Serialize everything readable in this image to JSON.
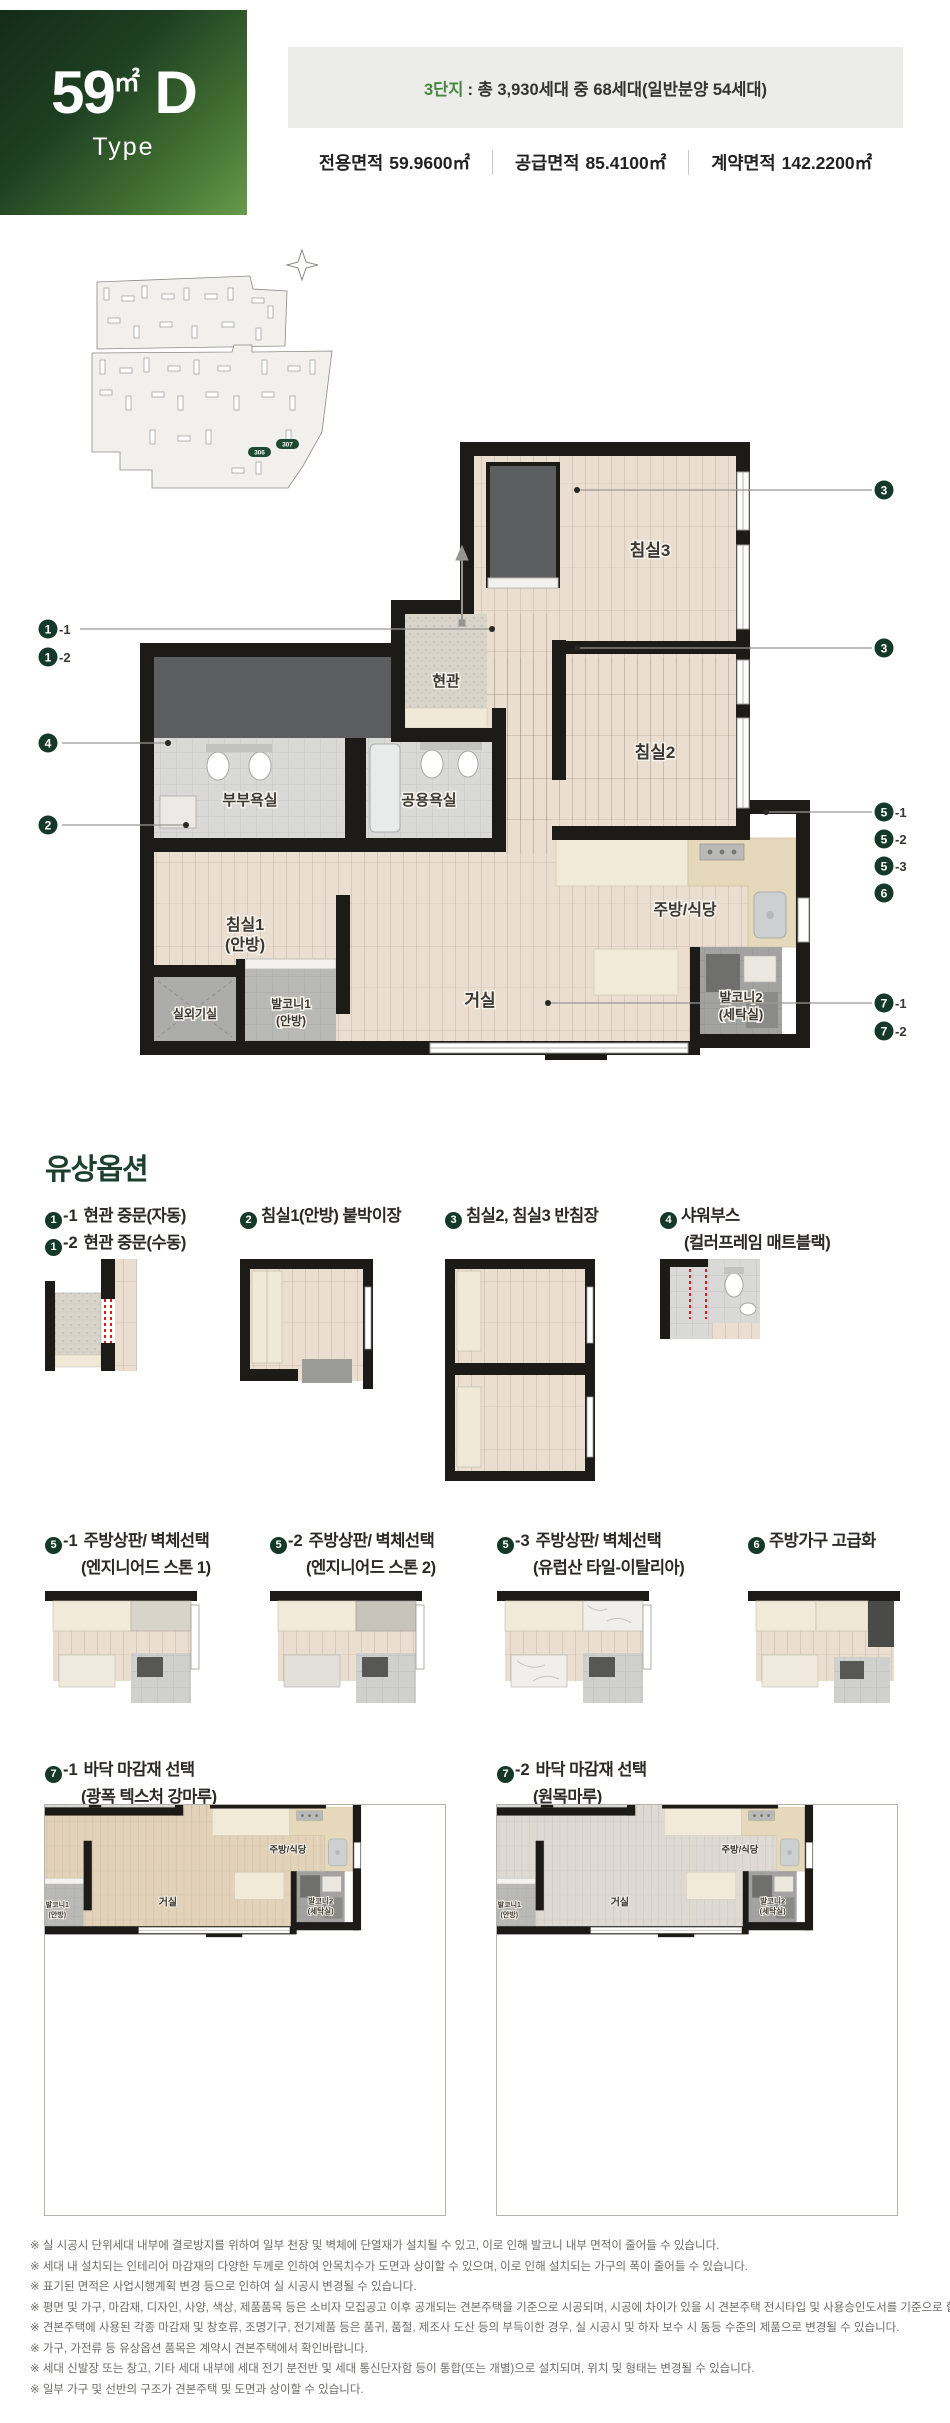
{
  "header": {
    "type_big": "59",
    "type_unit": "㎡",
    "type_letter": "D",
    "type_sub": "Type",
    "complex_prefix": "3단지",
    "complex_rest": ": 총 3,930세대 중 68세대(일반분양 54세대)",
    "areas": [
      {
        "label": "전용면적",
        "value": "59.9600㎡"
      },
      {
        "label": "공급면적",
        "value": "85.4100㎡"
      },
      {
        "label": "계약면적",
        "value": "142.2200㎡"
      }
    ]
  },
  "site_plan": {
    "badges": [
      "306",
      "307"
    ]
  },
  "floor_plan": {
    "rooms": {
      "entrance": "현관",
      "bed3": "침실3",
      "bed2": "침실2",
      "bath_master": "부부욕실",
      "bath_common": "공용욕실",
      "kitchen": "주방/식당",
      "bed1_line1": "침실1",
      "bed1_line2": "(안방)",
      "living": "거실",
      "balcony2_line1": "발코니2",
      "balcony2_line2": "(세탁실)",
      "outdoor_unit": "실외기실",
      "balcony1_line1": "발코니1",
      "balcony1_line2": "(안방)"
    },
    "callouts_left": [
      {
        "num": "1",
        "suffix": "-1"
      },
      {
        "num": "1",
        "suffix": "-2"
      },
      {
        "num": "4",
        "suffix": ""
      },
      {
        "num": "2",
        "suffix": ""
      }
    ],
    "callouts_right": [
      {
        "num": "3",
        "suffix": ""
      },
      {
        "num": "3",
        "suffix": ""
      },
      {
        "num": "5",
        "suffix": "-1"
      },
      {
        "num": "5",
        "suffix": "-2"
      },
      {
        "num": "5",
        "suffix": "-3"
      },
      {
        "num": "6",
        "suffix": ""
      },
      {
        "num": "7",
        "suffix": "-1"
      },
      {
        "num": "7",
        "suffix": "-2"
      }
    ]
  },
  "options": {
    "title": "유상옵션",
    "row1": [
      {
        "circle": "1",
        "suffix": "-1",
        "label": "현관 중문(자동)",
        "circle2": "1",
        "suffix2": "-2",
        "label2": "현관 중문(수동)"
      },
      {
        "circle": "2",
        "suffix": "",
        "label": "침실1(안방) 붙박이장"
      },
      {
        "circle": "3",
        "suffix": "",
        "label": "침실2, 침실3 반침장"
      },
      {
        "circle": "4",
        "suffix": "",
        "label": "샤워부스",
        "sub": "(컬러프레임 매트블랙)"
      }
    ],
    "row2": [
      {
        "circle": "5",
        "suffix": "-1",
        "label": "주방상판/ 벽체선택",
        "sub": "(엔지니어드 스톤 1)"
      },
      {
        "circle": "5",
        "suffix": "-2",
        "label": "주방상판/ 벽체선택",
        "sub": "(엔지니어드 스톤 2)"
      },
      {
        "circle": "5",
        "suffix": "-3",
        "label": "주방상판/ 벽체선택",
        "sub": "(유럽산 타일-이탈리아)"
      },
      {
        "circle": "6",
        "suffix": "",
        "label": "주방가구 고급화"
      }
    ],
    "row3": [
      {
        "circle": "7",
        "suffix": "-1",
        "label": "바닥 마감재 선택",
        "sub": "(광폭 텍스처 강마루)"
      },
      {
        "circle": "7",
        "suffix": "-2",
        "label": "바닥 마감재 선택",
        "sub": "(원목마루)"
      }
    ]
  },
  "notes": [
    "※ 실 시공시 단위세대 내부에 결로방지를 위하여 일부 천장 및 벽체에 단열재가 설치될 수 있고, 이로 인해 발코니 내부 면적이 줄어들 수 있습니다.",
    "※ 세대 내 설치되는 인테리어 마감재의 다양한 두께로 인하여 안목치수가 도면과 상이할 수 있으며, 이로 인해 설치되는 가구의 폭이 줄어들 수 있습니다.",
    "※ 표기된 면적은 사업시행계획 변경 등으로 인하여 실 시공시 변경될 수 있습니다.",
    "※ 평면 및 가구, 마감재, 디자인, 사양, 색상, 제품품목 등은 소비자 모집공고 이후 공개되는 견본주택을 기준으로 시공되며, 시공에 차이가 있을 시 견본주택 전시타입 및 사용승인도서를 기준으로 합니다.",
    "※ 견본주택에 사용된 각종 마감재 및 창호류, 조명기구, 전기제품 등은 품귀, 품절, 제조사 도산 등의 부득이한 경우, 실 시공시 및 하자 보수 시 동등 수준의 제품으로 변경될 수 있습니다.",
    "※ 가구, 가전류 등 유상옵션 품목은 계약시 견본주택에서 확인바랍니다.",
    "※ 세대 신발장 또는 창고, 기타 세대 내부에 세대 전기 분전반 및 세대 통신단자함 등이 통합(또는 개별)으로 설치되며, 위치 및 형태는 변경될 수 있습니다.",
    "※ 일부 가구 및 선반의 구조가 견본주택 및 도면과 상이할 수 있습니다."
  ]
}
